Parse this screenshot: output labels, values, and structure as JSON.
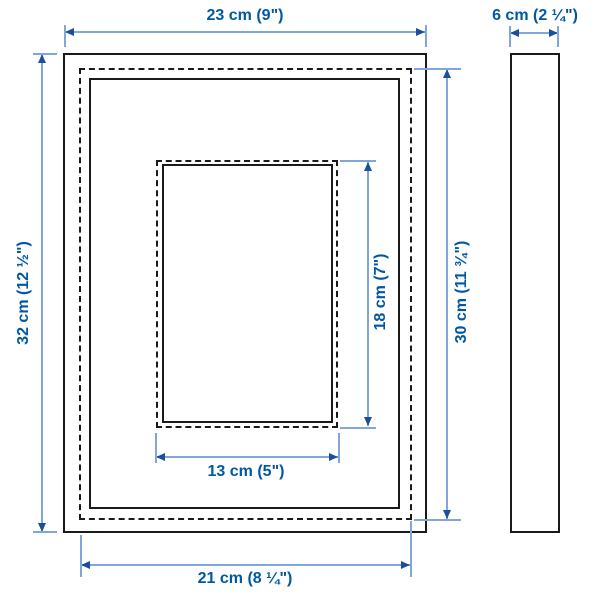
{
  "diagram_type": "picture-frame-measurement-diagram",
  "colors": {
    "dimension_text": "#0058a3",
    "dimension_line": "#7fa7da",
    "arrowhead": "#1d4e9e",
    "outline": "#1a1a1a",
    "background": "#ffffff"
  },
  "dimensions": {
    "outer_width": {
      "label": "23 cm (9\")",
      "cm": 23,
      "inches": "9"
    },
    "depth": {
      "label": "6 cm (2 ¼\")",
      "cm": 6,
      "inches": "2 ¼"
    },
    "outer_height": {
      "label": "32 cm (12 ½\")",
      "cm": 32,
      "inches": "12 ½"
    },
    "back_height": {
      "label": "30 cm (11 ¾\")",
      "cm": 30,
      "inches": "11 ¾"
    },
    "picture_height": {
      "label": "18 cm (7\")",
      "cm": 18,
      "inches": "7"
    },
    "picture_width": {
      "label": "13 cm (5\")",
      "cm": 13,
      "inches": "5"
    },
    "back_width": {
      "label": "21 cm (8 ¼\")",
      "cm": 21,
      "inches": "8 ¼"
    }
  }
}
